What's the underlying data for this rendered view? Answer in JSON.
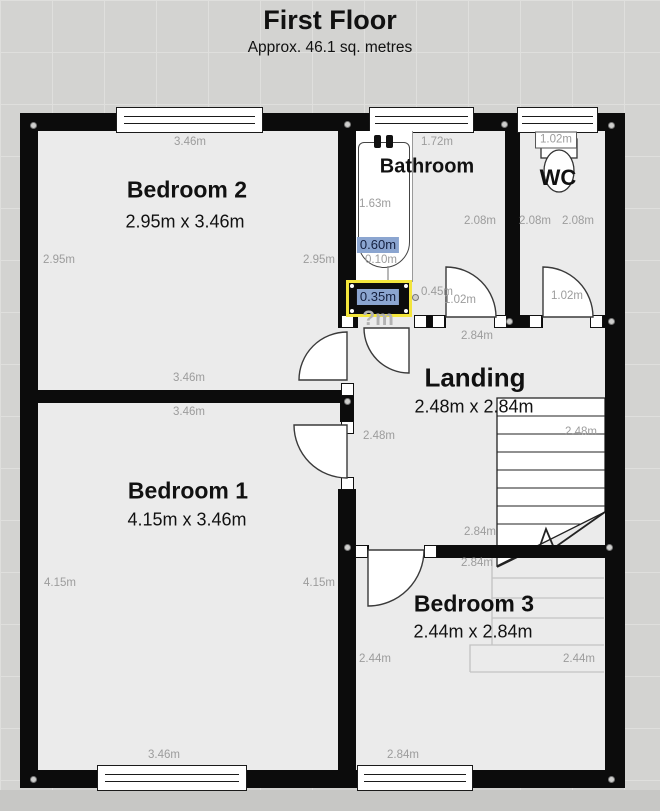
{
  "title": {
    "heading": "First Floor",
    "subtitle": "Approx. 46.1 sq. metres"
  },
  "rooms": {
    "bedroom2": {
      "name": "Bedroom 2",
      "dims": "2.95m x 3.46m"
    },
    "bathroom": {
      "name": "Bathroom"
    },
    "wc": {
      "name": "WC"
    },
    "landing": {
      "name": "Landing",
      "dims": "2.48m x 2.84m"
    },
    "bedroom1": {
      "name": "Bedroom 1",
      "dims": "4.15m x 3.46m"
    },
    "bedroom3": {
      "name": "Bedroom 3",
      "dims": "2.44m x 2.84m"
    }
  },
  "measurements": {
    "bed2_top": "3.46m",
    "bed2_left": "2.95m",
    "bed2_right": "2.95m",
    "bed2_bottom": "3.46m",
    "bed1_top": "3.46m",
    "bed1_left": "4.15m",
    "bed1_right": "4.15m",
    "bed1_bottom": "3.46m",
    "bath_top": "1.72m",
    "bath_length": "1.63m",
    "bath_width": "0.60m",
    "bath_gap": "0.10m",
    "bath_right": "2.08m",
    "bathroom_door": "1.02m",
    "wall_segment": "0.45m",
    "wc_top": "1.02m",
    "wc_left": "2.08m",
    "wc_right": "2.08m",
    "wc_door": "1.02m",
    "selected_wall_width": "0.35m",
    "unknown_opening": "?m",
    "landing_top": "2.84m",
    "landing_left": "2.48m",
    "landing_bottom": "2.84m",
    "stairs_width": "2.48m",
    "bed3_top": "2.84m",
    "bed3_left": "2.44m",
    "bed3_right": "2.44m",
    "bed3_bottom": "2.84m"
  },
  "colors": {
    "selection_border": "#f3e53c",
    "measurement_chip": "#8ba5d0",
    "wall": "#0c0c0c",
    "floor": "#ebebeb"
  }
}
